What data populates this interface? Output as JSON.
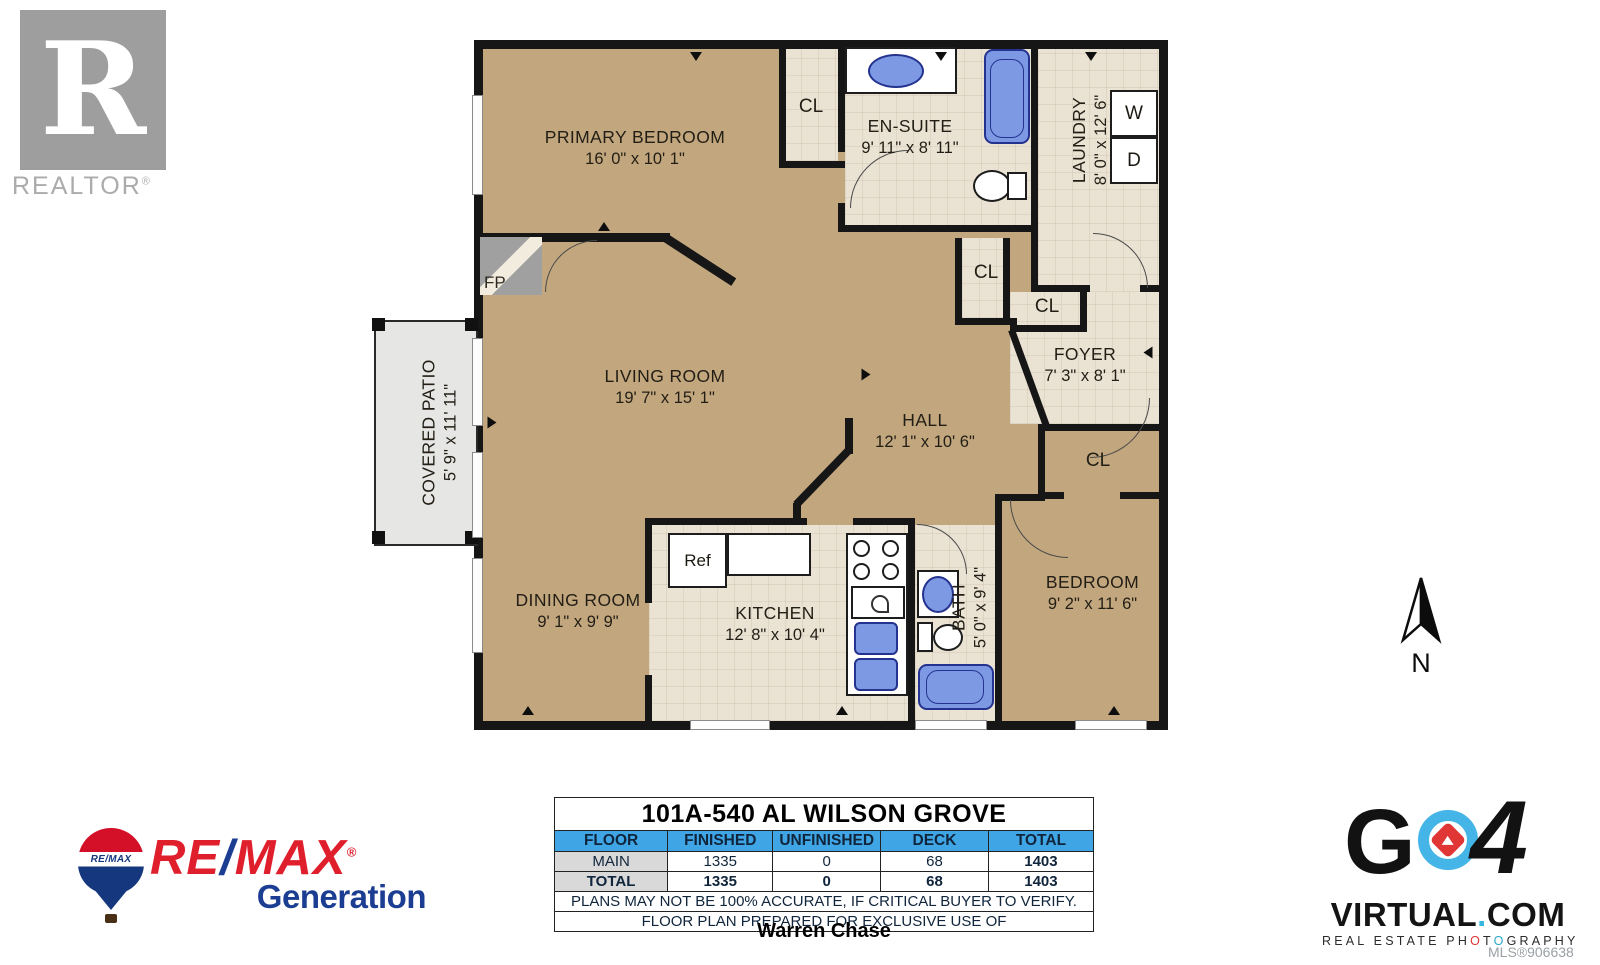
{
  "realtor": {
    "letter": "R",
    "wordmark": "REALTOR",
    "reg": "®"
  },
  "floorplan": {
    "rooms": {
      "primary_bedroom": {
        "name": "PRIMARY BEDROOM",
        "dims": "16' 0\" x 10' 1\""
      },
      "ensuite": {
        "name": "EN-SUITE",
        "dims": "9' 11\" x 8' 11\""
      },
      "laundry": {
        "name": "LAUNDRY",
        "dims": "8' 0\" x 12' 6\""
      },
      "living_room": {
        "name": "LIVING ROOM",
        "dims": "19' 7\" x 15' 1\""
      },
      "hall": {
        "name": "HALL",
        "dims": "12' 1\" x 10' 6\""
      },
      "foyer": {
        "name": "FOYER",
        "dims": "7' 3\" x 8' 1\""
      },
      "covered_patio": {
        "name": "COVERED PATIO",
        "dims": "5' 9\" x 11' 11\""
      },
      "dining_room": {
        "name": "DINING ROOM",
        "dims": "9' 1\" x 9' 9\""
      },
      "kitchen": {
        "name": "KITCHEN",
        "dims": "12' 8\" x 10' 4\""
      },
      "bath": {
        "name": "BATH",
        "dims": "5' 0\" x 9' 4\""
      },
      "bedroom": {
        "name": "BEDROOM",
        "dims": "9' 2\" x 11' 6\""
      }
    },
    "labels": {
      "closet": "CL",
      "fireplace": "FP",
      "washer": "W",
      "dryer": "D",
      "fridge": "Ref"
    },
    "compass": {
      "north": "N"
    }
  },
  "summary_table": {
    "title": "101A-540 AL WILSON GROVE",
    "headers": [
      "FLOOR",
      "FINISHED",
      "UNFINISHED",
      "DECK",
      "TOTAL"
    ],
    "rows": [
      {
        "floor": "MAIN",
        "finished": "1335",
        "unfinished": "0",
        "deck": "68",
        "total": "1403"
      },
      {
        "floor": "TOTAL",
        "finished": "1335",
        "unfinished": "0",
        "deck": "68",
        "total": "1403"
      }
    ],
    "disclaimer": "PLANS MAY NOT BE 100% ACCURATE, IF CRITICAL BUYER TO VERIFY.",
    "prepared_for": "FLOOR PLAN PREPARED FOR EXCLUSIVE USE OF",
    "client": "Warren Chase"
  },
  "remax": {
    "re": "RE",
    "slash": "/",
    "max": "MAX",
    "reg": "®",
    "sub": "Generation",
    "balloon_text": "RE/MAX"
  },
  "go4": {
    "g": "G",
    "four": "4",
    "domain_v": "VIRTUAL",
    "domain_dot": ".",
    "domain_com": "COM",
    "tag_p1": "REAL ESTATE PH",
    "tag_o1": "O",
    "tag_t": "T",
    "tag_o2": "O",
    "tag_p2": "GRAPHY",
    "mls": "MLS®906638"
  }
}
